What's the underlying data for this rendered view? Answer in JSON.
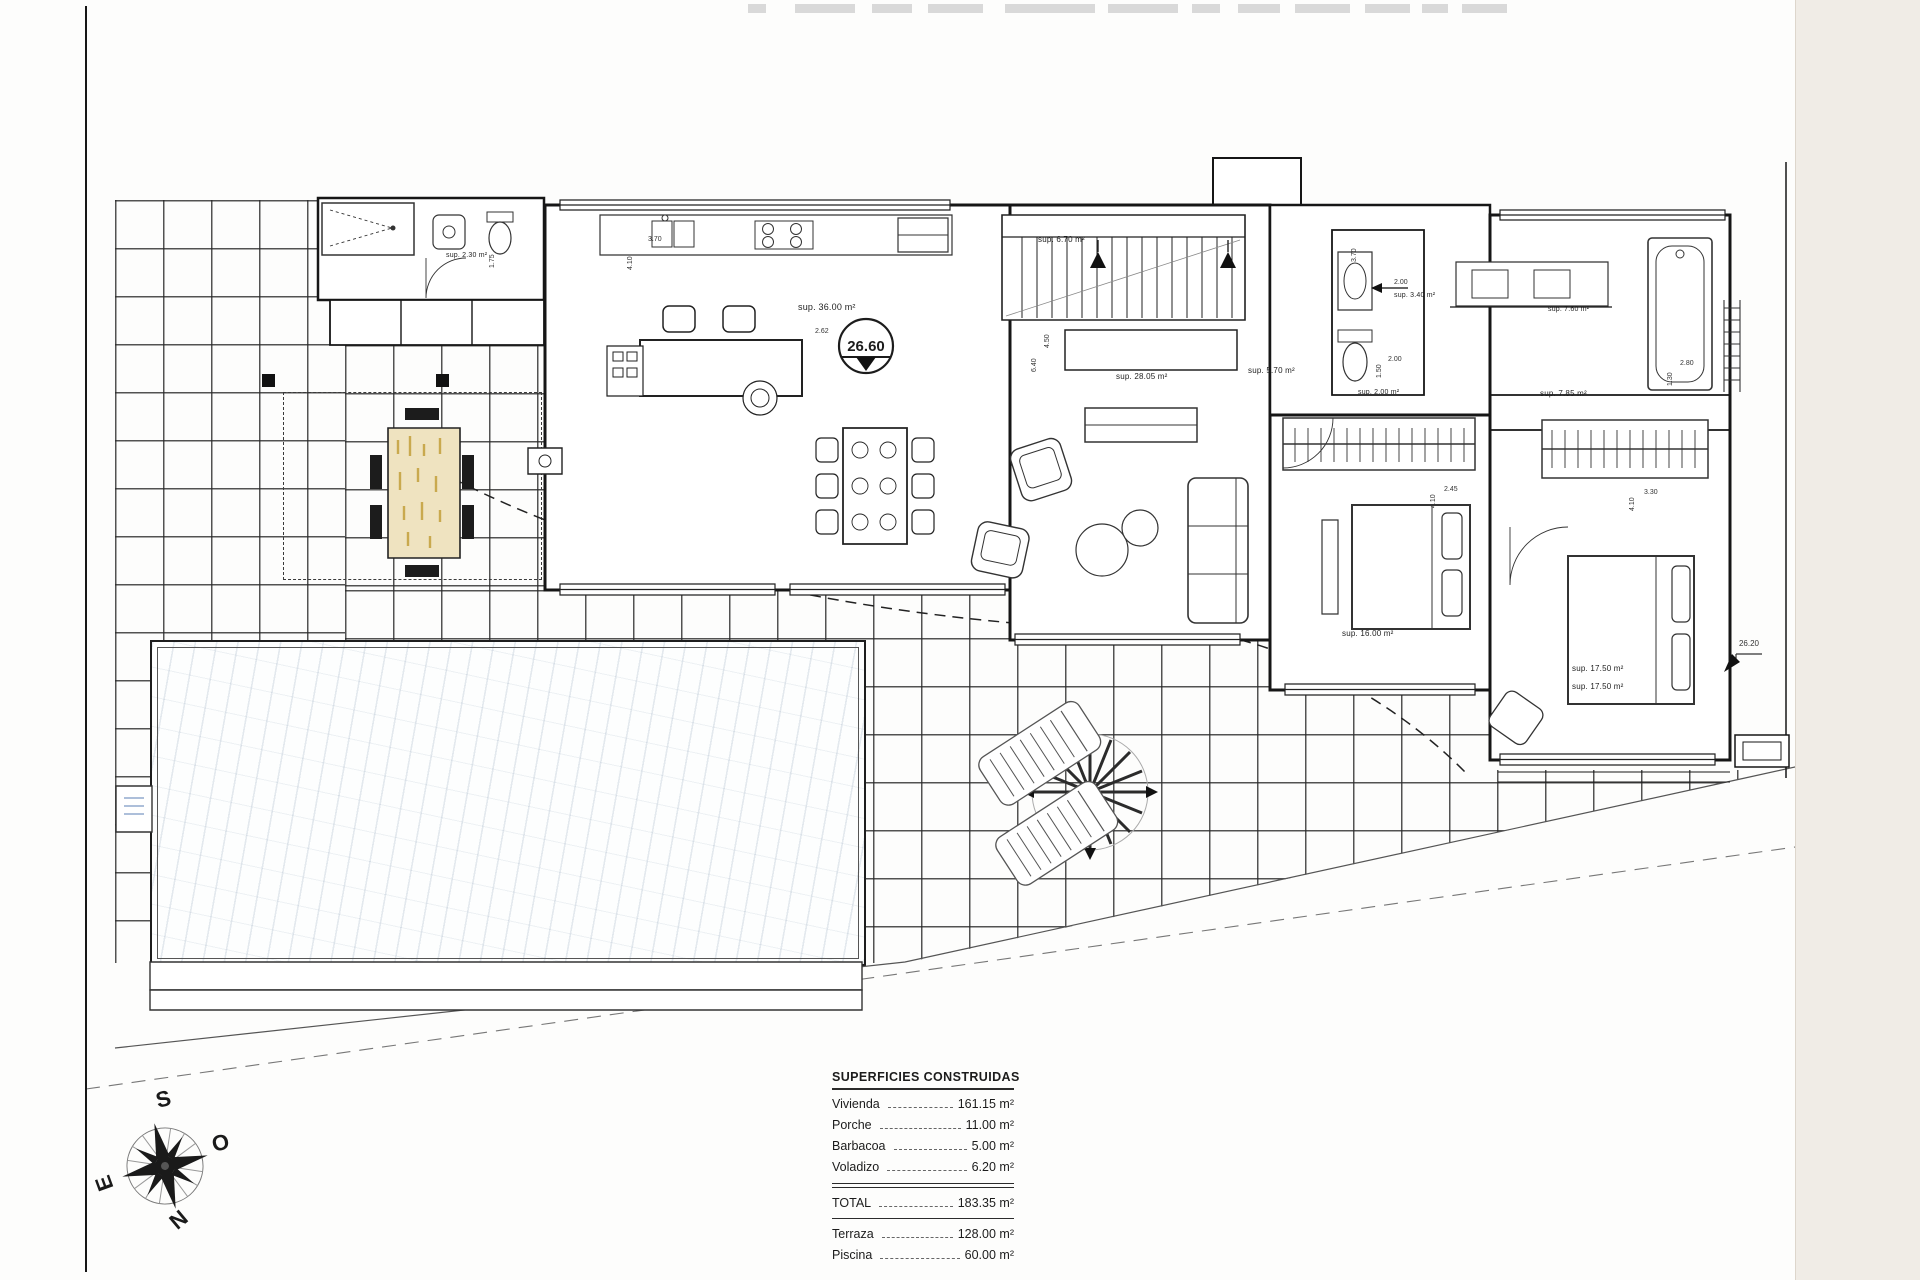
{
  "drawing": {
    "table": {
      "title": "SUPERFICIES CONSTRUIDAS",
      "rows": [
        {
          "label": "Vivienda",
          "value": "161.15 m²"
        },
        {
          "label": "Porche",
          "value": "11.00 m²"
        },
        {
          "label": "Barbacoa",
          "value": "5.00 m²"
        },
        {
          "label": "Voladizo",
          "value": "6.20 m²"
        }
      ],
      "total": {
        "label": "TOTAL",
        "value": "183.35 m²"
      },
      "outdoor_rows": [
        {
          "label": "Terraza",
          "value": "128.00 m²"
        },
        {
          "label": "Piscina",
          "value": "60.00 m²"
        }
      ]
    },
    "levels": {
      "main_floor": "26.60",
      "terrace": "26.20"
    },
    "compass": {
      "top": "S",
      "right": "O",
      "left": "E",
      "bottom": "N"
    },
    "room_labels": [
      "sup. 2.30 m²",
      "sup. 36.00 m²",
      "sup. 6.70 m²",
      "sup. 28.05 m²",
      "sup. 5.70 m²",
      "sup. 3.40 m²",
      "sup. 7.60 m²",
      "sup. 7.85 m²",
      "sup. 2.00 m²",
      "sup. 16.00 m²",
      "sup. 17.50 m²",
      "sup. 17.50 m²"
    ],
    "dimension_labels": [
      "3.70",
      "4.10",
      "2.62",
      "4.50",
      "6.40",
      "2.00",
      "1.50",
      "2.45",
      "4.10",
      "3.30",
      "4.10",
      "2.80",
      "1.30",
      "1.75",
      "2.00",
      "3.70"
    ]
  }
}
